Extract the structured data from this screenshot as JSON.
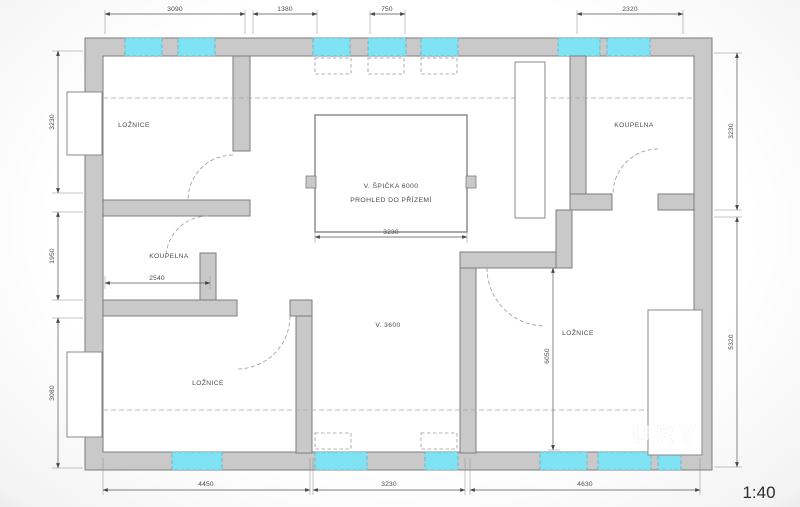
{
  "plan": {
    "scale_label": "1:40",
    "watermark": "URY",
    "rooms": {
      "bedroom_top_left": "LOŽNICE",
      "bathroom_left": "KOUPELNA",
      "bedroom_bottom_left": "LOŽNICE",
      "bathroom_top_right": "KOUPELNA",
      "bedroom_right": "LOŽNICE"
    },
    "void_area": {
      "line1": "V. ŠPIČKA 6000",
      "line2": "PROHLED DO PŘÍZEMÍ",
      "width_dim": "3230"
    },
    "hall_height_label": "V. 3600",
    "dims": {
      "top": [
        "3090",
        "1380",
        "750",
        "2320"
      ],
      "left": [
        "3230",
        "1950",
        "3080"
      ],
      "right": [
        "3230",
        "5320"
      ],
      "bottom": [
        "4450",
        "3230",
        "4630"
      ],
      "bathroom_width": "2540",
      "bedroom_right_height": "6050"
    },
    "colors": {
      "wall_fill": "#c9c9c9",
      "wall_stroke": "#7d7d7d",
      "window_fill": "#7fe3f4",
      "dim_line": "#555555"
    }
  }
}
